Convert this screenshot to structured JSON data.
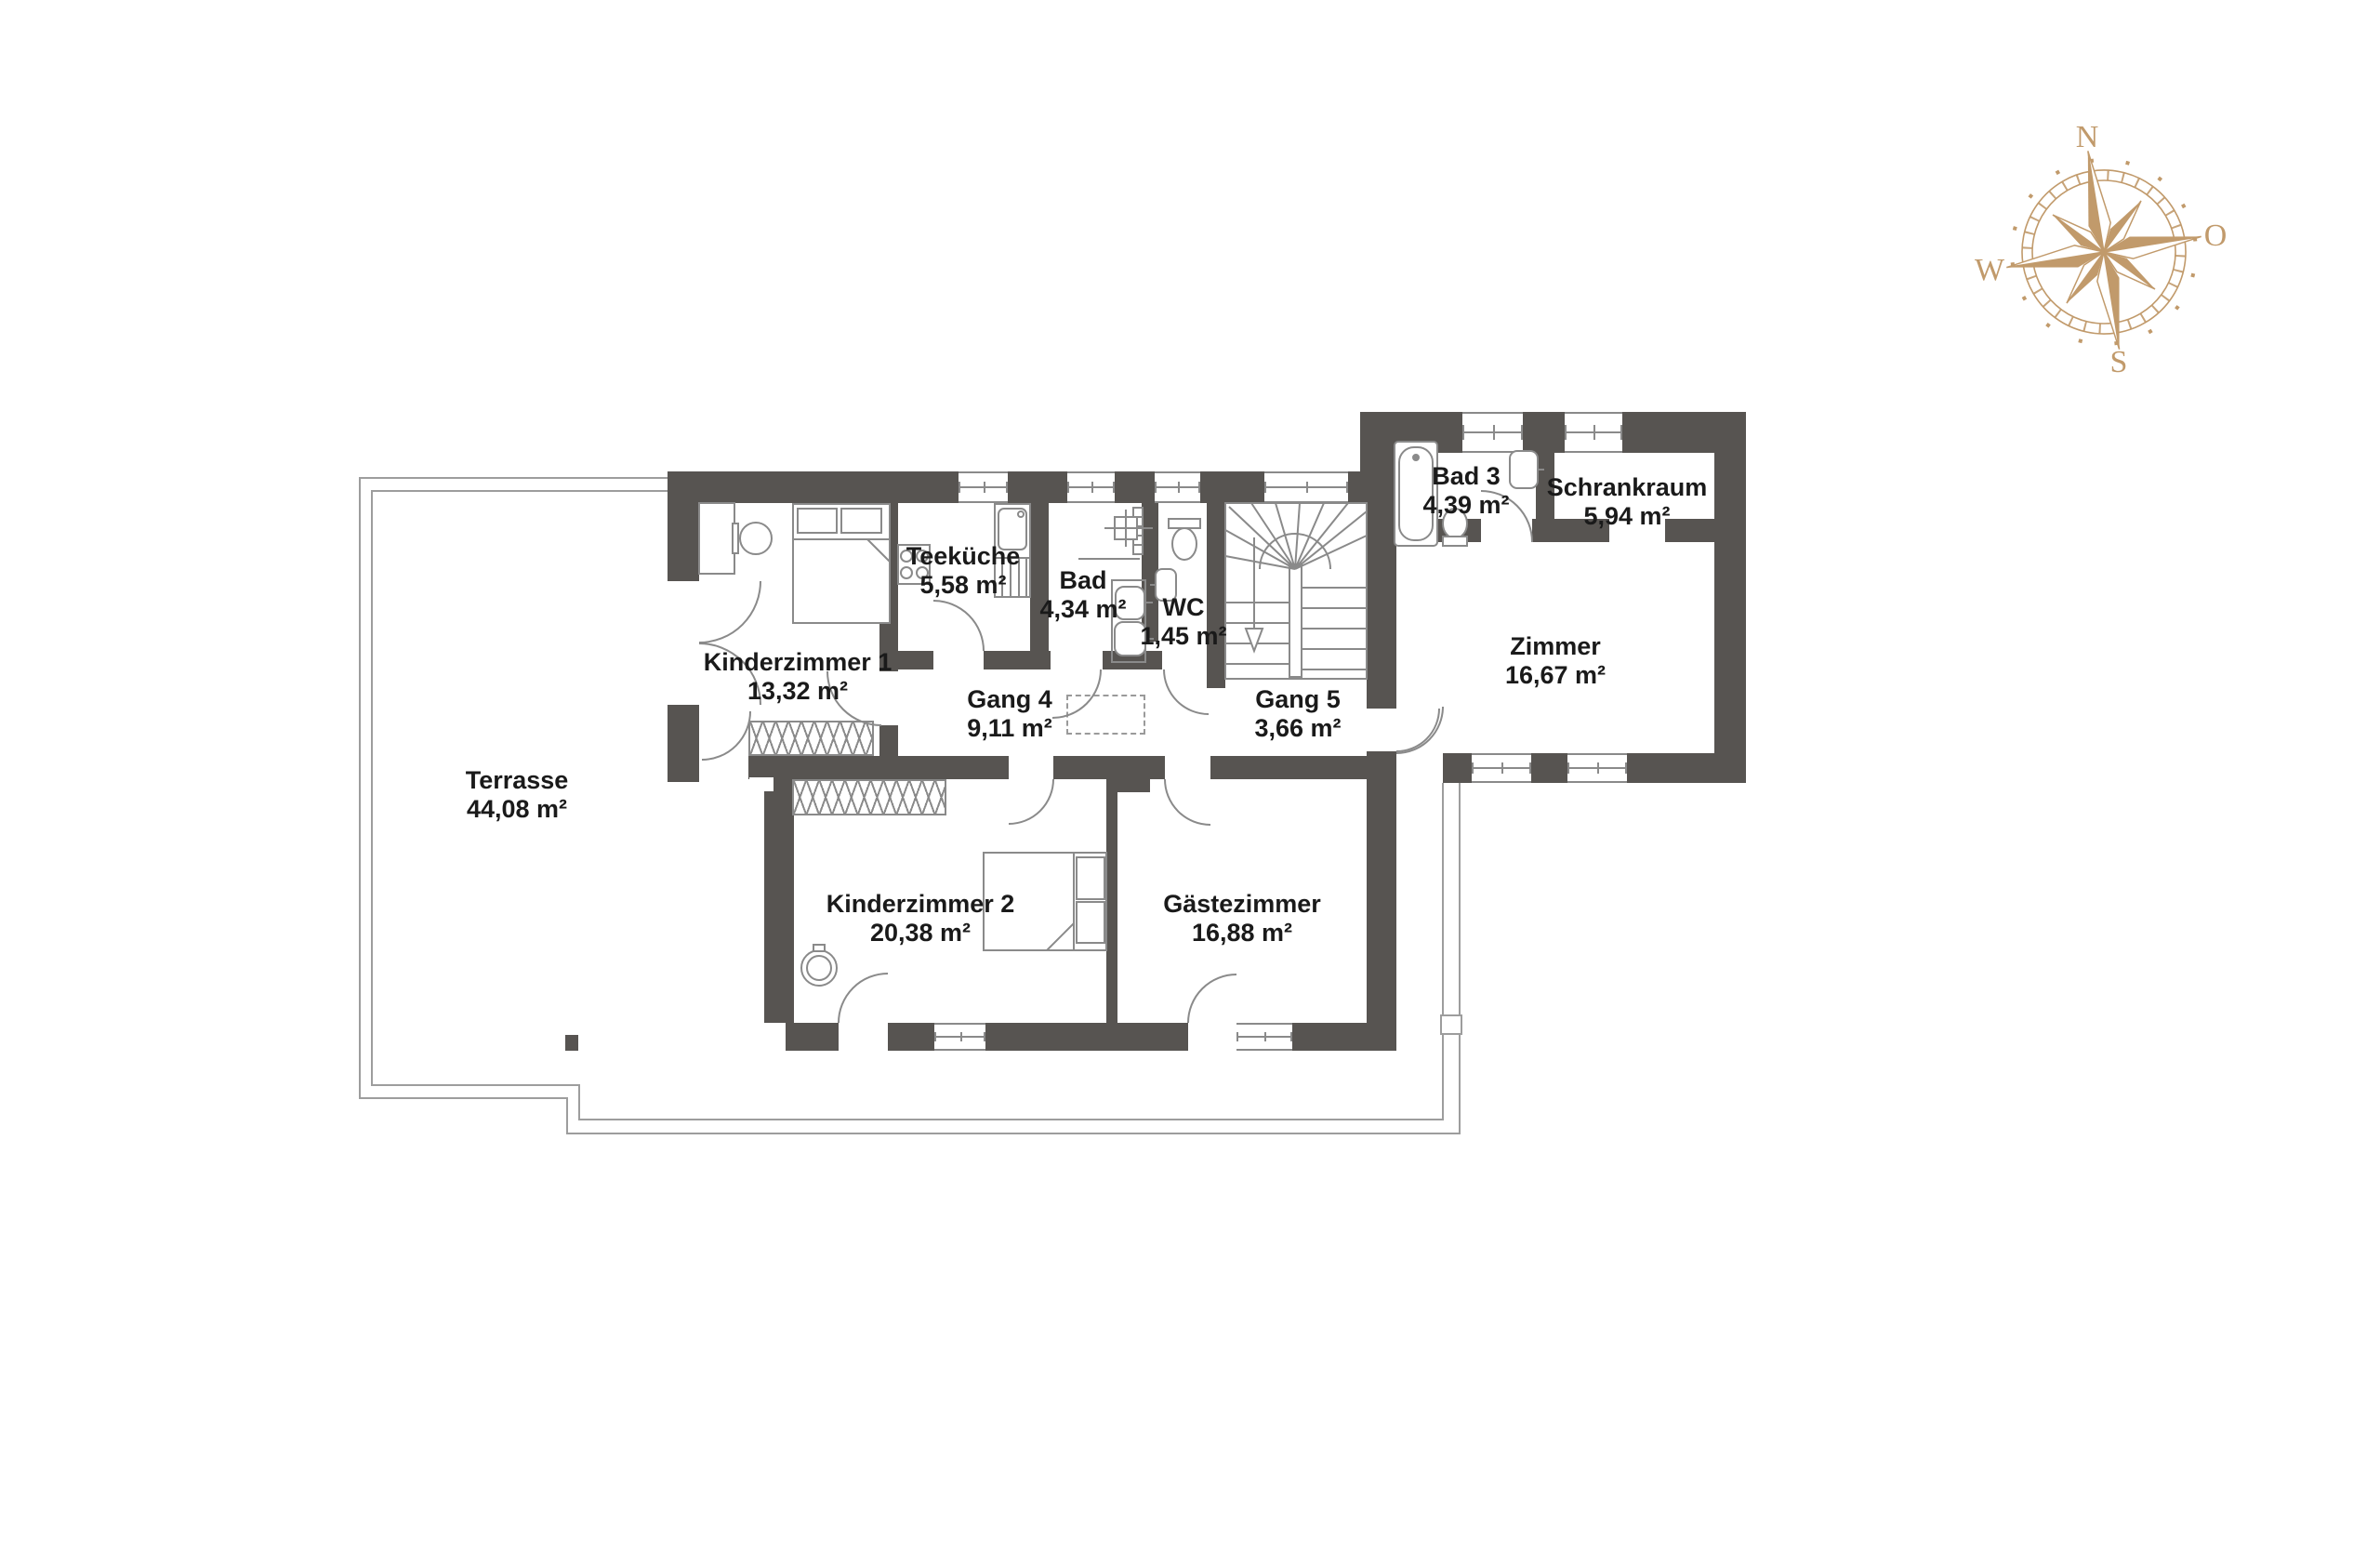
{
  "compass": {
    "north": "N",
    "east": "O",
    "south": "S",
    "west": "W"
  },
  "rooms": {
    "terrasse": {
      "name": "Terrasse",
      "area": "44,08 m²"
    },
    "kinderzimmer1": {
      "name": "Kinderzimmer 1",
      "area": "13,32 m²"
    },
    "teekueche": {
      "name": "Teeküche",
      "area": "5,58 m²"
    },
    "bad": {
      "name": "Bad",
      "area": "4,34 m²"
    },
    "wc": {
      "name": "WC",
      "area": "1,45 m²"
    },
    "gang4": {
      "name": "Gang 4",
      "area": "9,11 m²"
    },
    "gang5": {
      "name": "Gang 5",
      "area": "3,66 m²"
    },
    "kinderzimmer2": {
      "name": "Kinderzimmer 2",
      "area": "20,38 m²"
    },
    "gaestezimmer": {
      "name": "Gästezimmer",
      "area": "16,88 m²"
    },
    "bad3": {
      "name": "Bad 3",
      "area": "4,39 m²"
    },
    "schrankraum": {
      "name": "Schrankraum",
      "area": "5,94 m²"
    },
    "zimmer": {
      "name": "Zimmer",
      "area": "16,67 m²"
    }
  },
  "colors": {
    "wall": "#575451",
    "thin_line": "#8a8a8a",
    "compass": "#c19a6b",
    "text": "#1a1a1a"
  }
}
